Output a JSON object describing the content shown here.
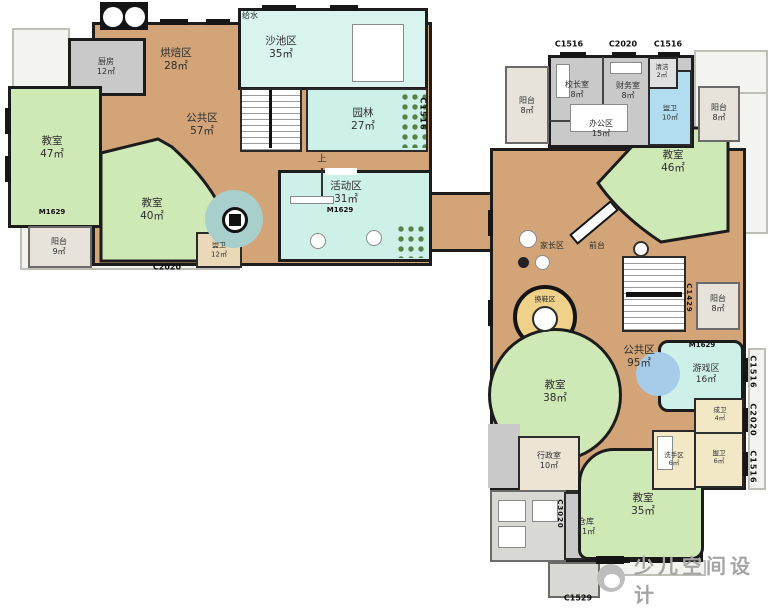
{
  "watermark": {
    "brand": "少儿空间设计"
  },
  "palette": {
    "floor_wood": "#d2a478",
    "classroom_green": "#cfe9b6",
    "play_cyan": "#cdf0e9",
    "service_gray": "#c9c9c9",
    "washroom_blue": "#b2ddf0",
    "toilet_cream": "#f3e8c6",
    "shoe_yellow": "#f0d189",
    "wall_black": "#1c1c1c",
    "watermark_gray": "#a4a4a4"
  },
  "left_wing": {
    "entry_note": "给水",
    "stair_up": "上",
    "rooms": {
      "kitchen": {
        "name": "厨房",
        "area": "12㎡"
      },
      "baking": {
        "name": "烘焙区",
        "area": "28㎡"
      },
      "sand_pool": {
        "name": "沙池区",
        "area": "35㎡"
      },
      "garden": {
        "name": "园林",
        "area": "27㎡"
      },
      "public_zone": {
        "name": "公共区",
        "area": "57㎡"
      },
      "classroom_47": {
        "name": "教室",
        "area": "47㎡"
      },
      "classroom_40": {
        "name": "教室",
        "area": "40㎡"
      },
      "activity": {
        "name": "活动区",
        "area": "31㎡"
      },
      "balcony_9": {
        "name": "阳台",
        "area": "9㎡"
      },
      "washroom_12": {
        "name": "盥卫",
        "area": "12㎡"
      }
    },
    "codes": {
      "bottom_door": "C2020",
      "right_window": "C1516",
      "classroom_door": "M1629",
      "activity_door": "M1629"
    }
  },
  "right_wing": {
    "rooms": {
      "principal_office": {
        "name": "校长室",
        "area": "8㎡"
      },
      "finance_office": {
        "name": "财务室",
        "area": "8㎡"
      },
      "cleaning": {
        "name": "清洁",
        "area": "2㎡"
      },
      "washroom_10": {
        "name": "盥卫",
        "area": "10㎡"
      },
      "office_zone": {
        "name": "办公区",
        "area": "15㎡"
      },
      "balcony_top_left": {
        "name": "阳台",
        "area": "8㎡"
      },
      "balcony_top_right": {
        "name": "阳台",
        "area": "8㎡"
      },
      "classroom_46": {
        "name": "教室",
        "area": "46㎡"
      },
      "parents_zone": {
        "name": "家长区"
      },
      "front_desk": {
        "name": "前台"
      },
      "shoe_change": {
        "name": "换鞋区"
      },
      "balcony_mid": {
        "name": "阳台",
        "area": "8㎡"
      },
      "public_zone": {
        "name": "公共区",
        "area": "95㎡"
      },
      "game_zone": {
        "name": "游戏区",
        "area": "16㎡"
      },
      "classroom_38": {
        "name": "教室",
        "area": "38㎡"
      },
      "admin_office": {
        "name": "行政室",
        "area": "10㎡"
      },
      "adult_wc": {
        "name": "成卫",
        "area": "4㎡"
      },
      "handwash": {
        "name": "洗手区",
        "area": "6㎡"
      },
      "washroom_6": {
        "name": "盥卫",
        "area": "6㎡"
      },
      "classroom_35": {
        "name": "教室",
        "area": "35㎡"
      },
      "storage": {
        "name": "仓库",
        "area": "11㎡"
      }
    },
    "codes": {
      "top_window_left": "C1516",
      "top_door": "C2020",
      "top_window_right": "C1516",
      "mid_balcony": "C1429",
      "game_door": "M1629",
      "right_window_1": "C1516",
      "right_door": "C2020",
      "right_window_2": "C1516",
      "storage_window": "C3020",
      "bottom_window": "C1529"
    }
  }
}
